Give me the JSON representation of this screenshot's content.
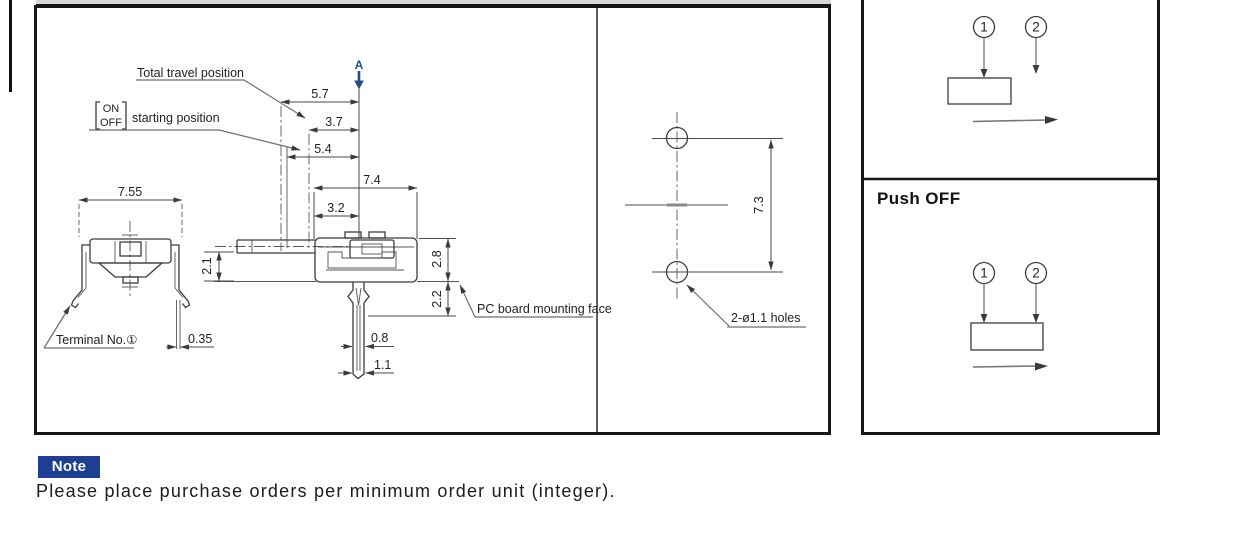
{
  "drawing": {
    "labels": {
      "total_travel": "Total travel position",
      "on": "ON",
      "off": "OFF",
      "starting_position": "starting position",
      "section": "A",
      "terminal": "Terminal No.①",
      "pc_board": "PC board mounting face"
    },
    "dims": {
      "d5_7": "5.7",
      "d3_7": "3.7",
      "d5_4": "5.4",
      "d7_4": "7.4",
      "d3_2": "3.2",
      "d7_55": "7.55",
      "d2_1": "2.1",
      "d2_8": "2.8",
      "d2_2": "2.2",
      "d0_35": "0.35",
      "d0_8": "0.8",
      "d1_1": "1.1"
    }
  },
  "mounting": {
    "pitch": "7.3",
    "holes": "2-ø1.1 holes"
  },
  "circuit": {
    "t1": "1",
    "t2": "2",
    "push_off": "Push OFF"
  },
  "note": {
    "badge": "Note",
    "text": "Please place purchase orders per minimum order unit (integer)."
  },
  "colors": {
    "note_badge_blue": "#1c3f94",
    "section_arrow_blue": "#1d5186",
    "line_dark": "#3c3c3c"
  }
}
